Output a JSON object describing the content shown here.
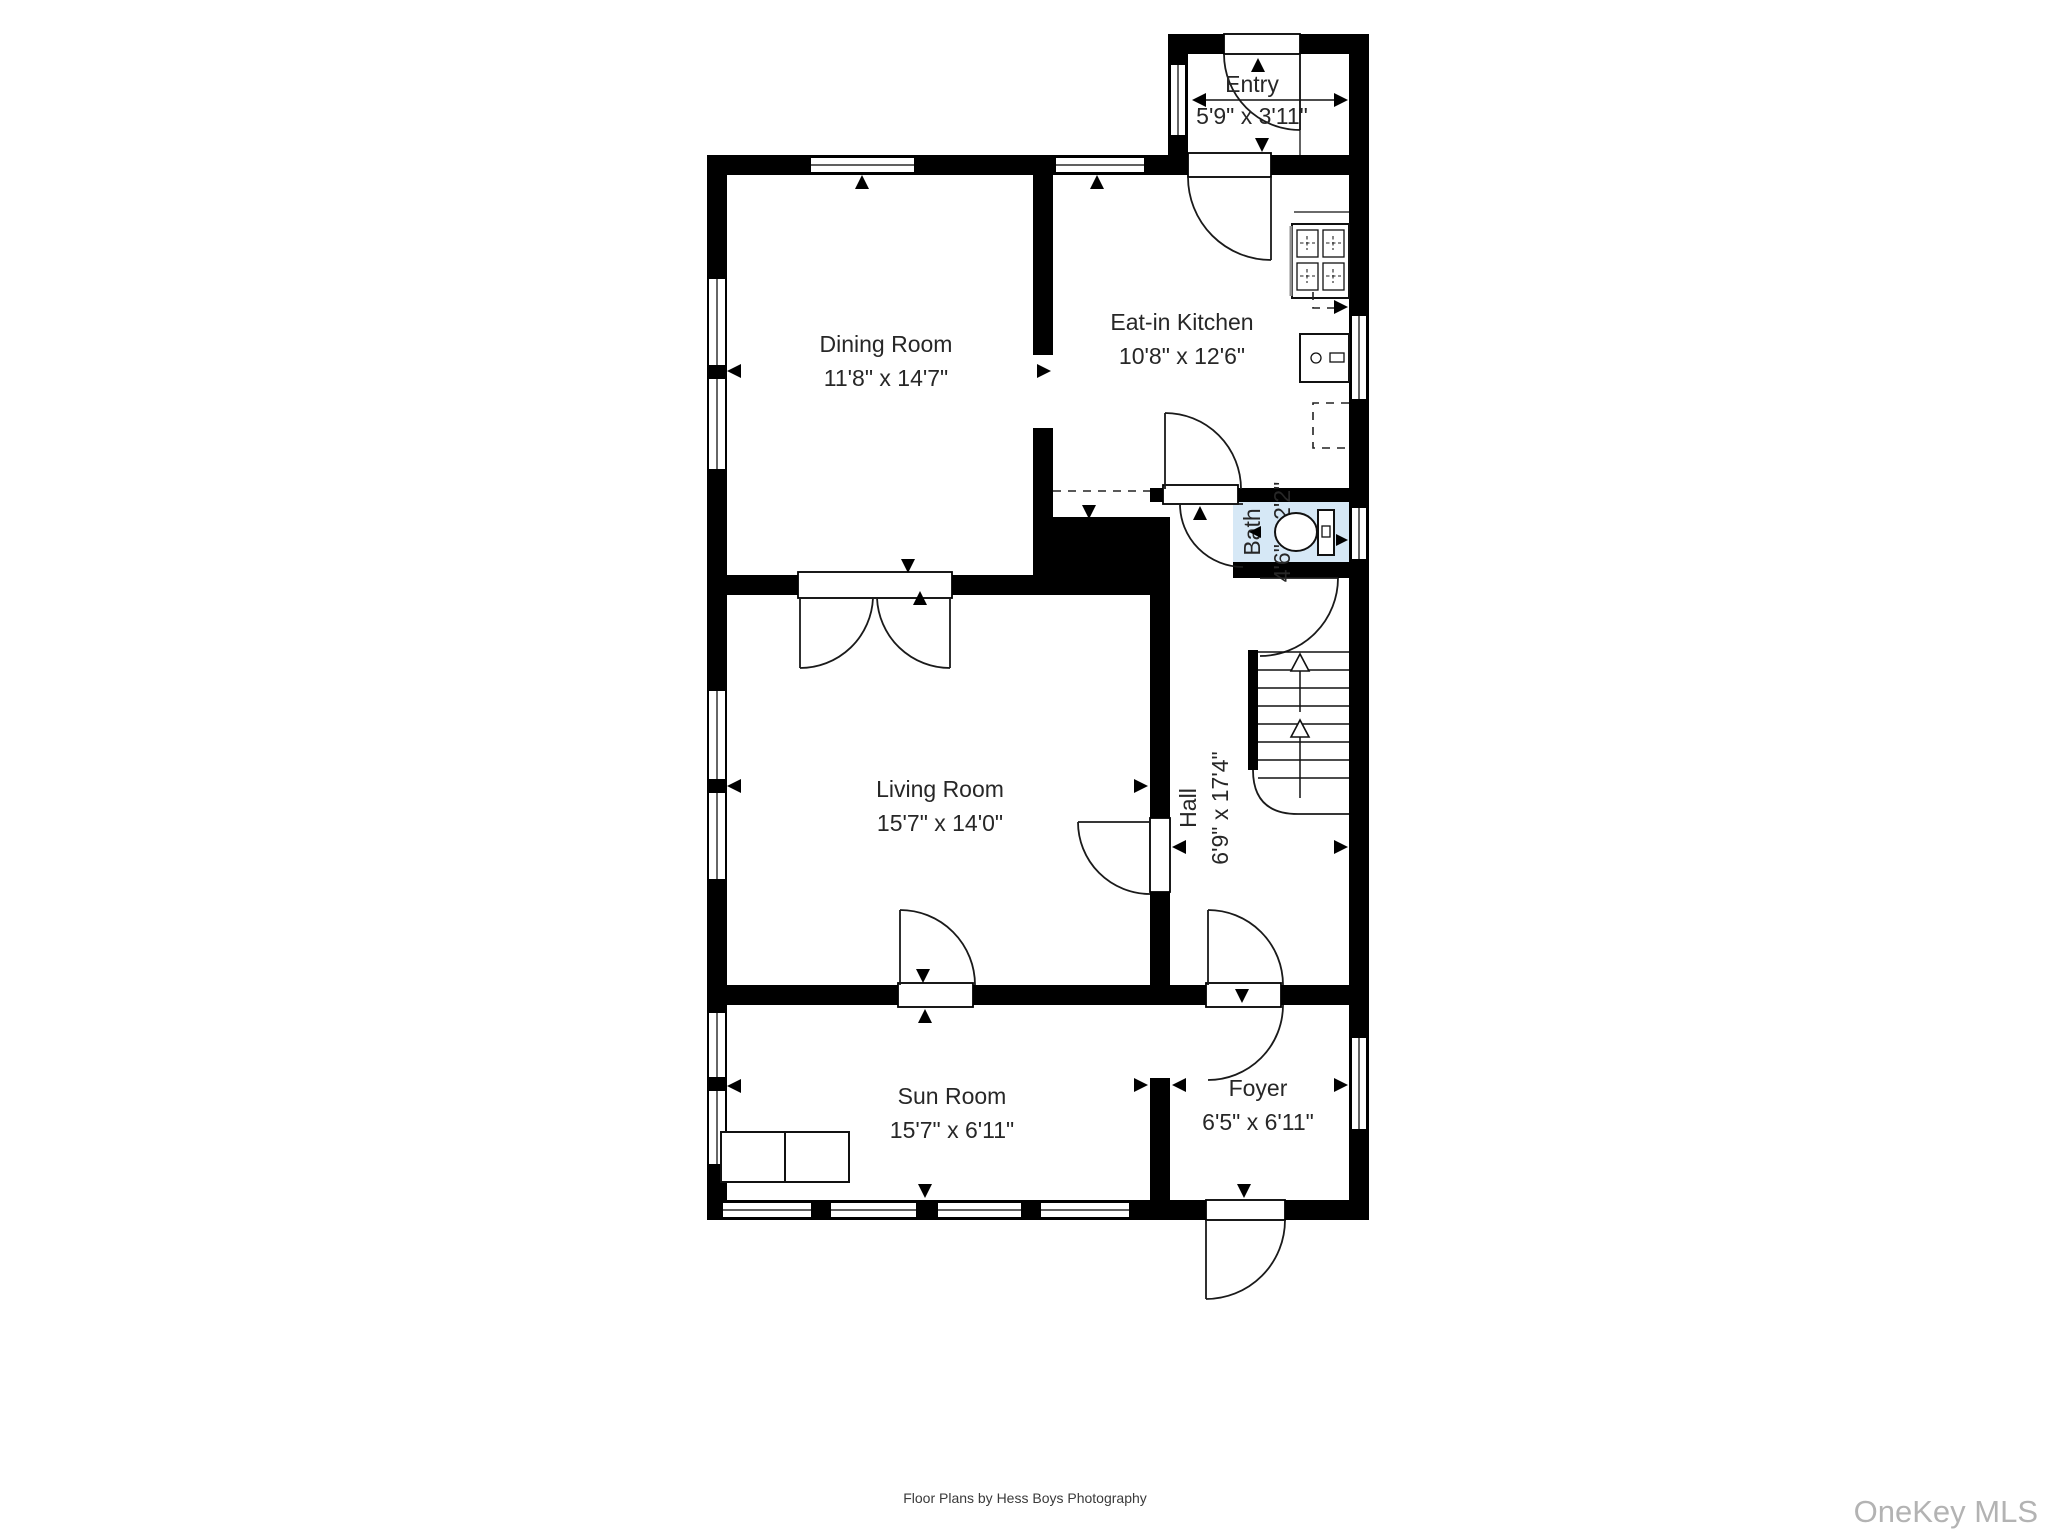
{
  "plan": {
    "colors": {
      "wall": "#000000",
      "bath_floor": "#d6e8f6",
      "label": "#272727",
      "line": "#111111"
    },
    "rooms": [
      {
        "id": "entry",
        "name": "Entry",
        "dimensions": "5'9\" x 3'11\""
      },
      {
        "id": "eat_in_kitchen",
        "name": "Eat-in Kitchen",
        "dimensions": "10'8\" x 12'6\""
      },
      {
        "id": "dining_room",
        "name": "Dining Room",
        "dimensions": "11'8\" x 14'7\""
      },
      {
        "id": "bath",
        "name": "Bath",
        "dimensions": "4'6\" x 2'2\""
      },
      {
        "id": "hall",
        "name": "Hall",
        "dimensions": "6'9\" x 17'4\""
      },
      {
        "id": "living_room",
        "name": "Living Room",
        "dimensions": "15'7\" x 14'0\""
      },
      {
        "id": "sun_room",
        "name": "Sun Room",
        "dimensions": "15'7\" x 6'11\""
      },
      {
        "id": "foyer",
        "name": "Foyer",
        "dimensions": "6'5\" x 6'11\""
      }
    ],
    "fixtures": [
      {
        "name": "stove"
      },
      {
        "name": "kitchen-sink"
      },
      {
        "name": "toilet"
      },
      {
        "name": "staircase"
      },
      {
        "name": "window-seat"
      }
    ],
    "stairs": {
      "direction": "up"
    }
  },
  "footer": {
    "caption": "Floor Plans by Hess Boys Photography"
  },
  "watermark": {
    "text": "OneKey MLS",
    "color": "#b3b3b3"
  }
}
